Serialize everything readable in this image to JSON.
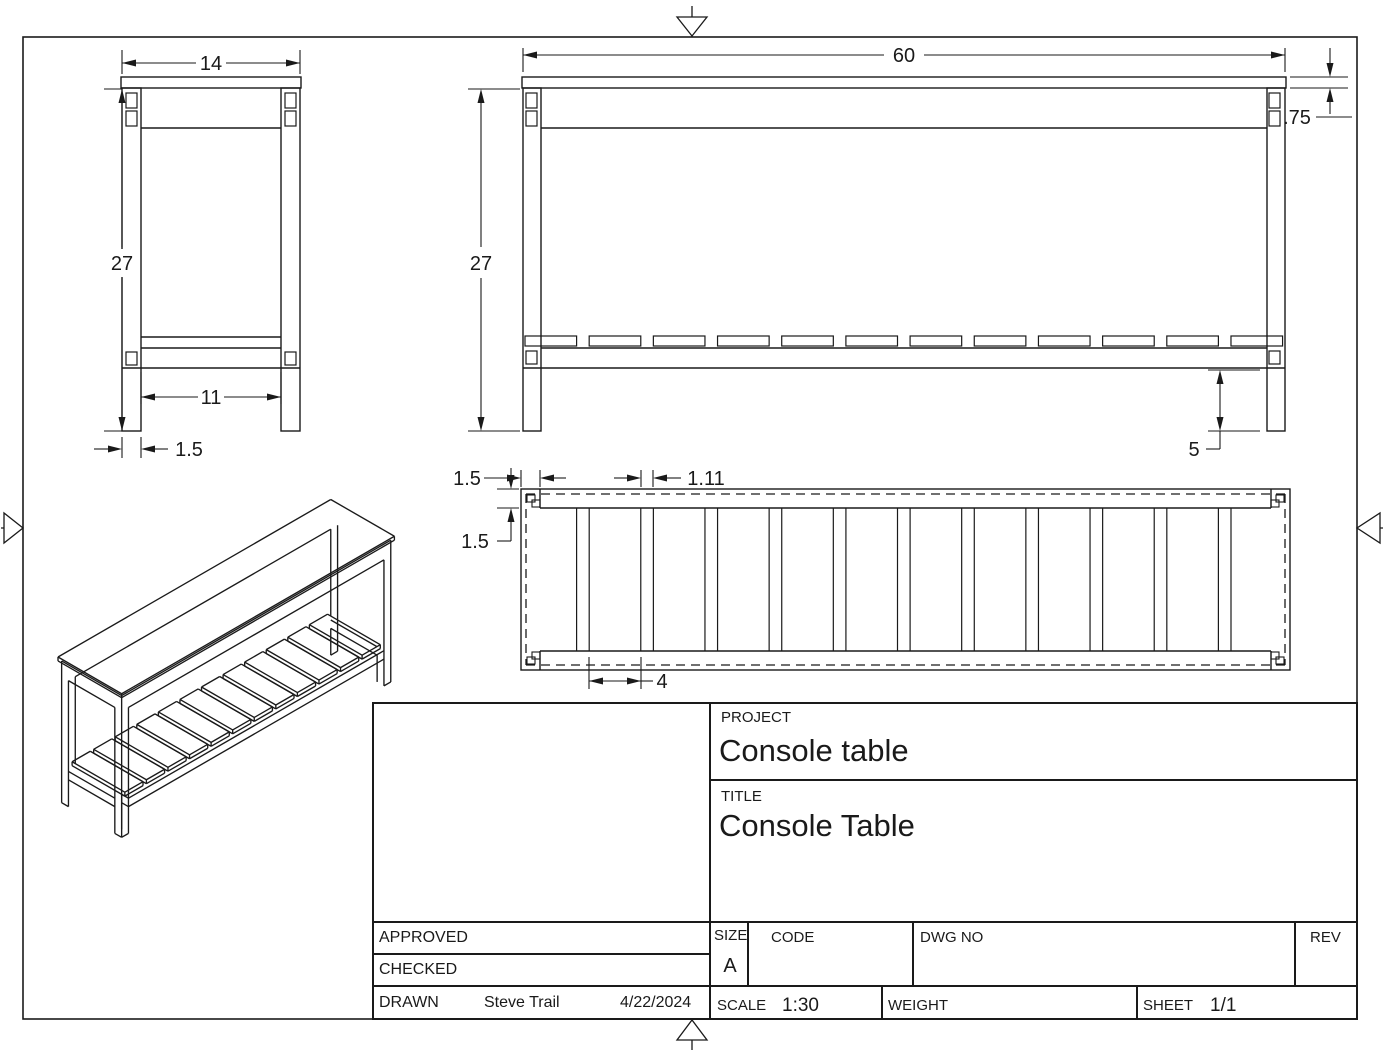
{
  "sheet": {
    "line_color": "#1a1a1a",
    "background": "#ffffff"
  },
  "views": {
    "side": {
      "dims": {
        "width": "14",
        "height": "27",
        "inner": "11",
        "leg": "1.5"
      }
    },
    "front": {
      "dims": {
        "width": "60",
        "height": "27",
        "top_thickness": ".75",
        "shelf_height": "5"
      }
    },
    "plan": {
      "dims": {
        "rail_end": "1.5",
        "rail_side": "1.5",
        "slat_gap": "1.11",
        "slat_width": "4"
      }
    }
  },
  "title_block": {
    "project_label": "PROJECT",
    "project_value": "Console table",
    "title_label": "TITLE",
    "title_value": "Console Table",
    "approved_label": "APPROVED",
    "approved_value": "",
    "checked_label": "CHECKED",
    "checked_value": "",
    "drawn_label": "DRAWN",
    "drawn_by": "Steve Trail",
    "drawn_date": "4/22/2024",
    "size_label": "SIZE",
    "size_value": "A",
    "code_label": "CODE",
    "code_value": "",
    "dwg_no_label": "DWG NO",
    "dwg_no_value": "",
    "rev_label": "REV",
    "rev_value": "",
    "scale_label": "SCALE",
    "scale_value": "1:30",
    "weight_label": "WEIGHT",
    "weight_value": "",
    "sheet_label": "SHEET",
    "sheet_value": "1/1"
  }
}
